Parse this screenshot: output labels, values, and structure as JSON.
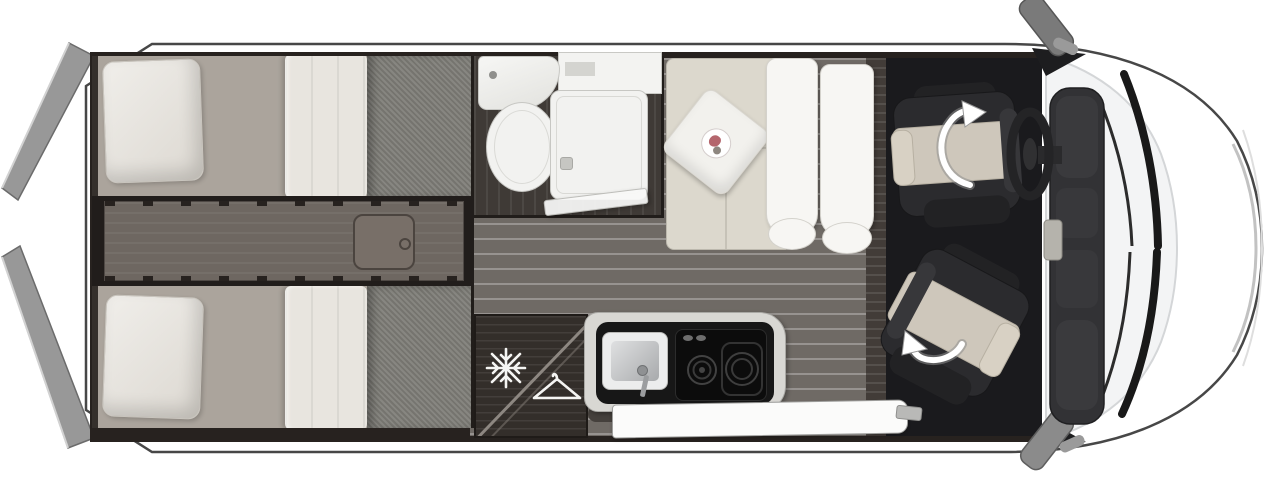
{
  "scene": {
    "subject": "camper-van-floor-plan-top-view",
    "background_color": "#ffffff",
    "orientation": "van front on the right, rear doors open on the left"
  },
  "palette": {
    "body_white": "#ffffff",
    "body_outline": "#474747",
    "door_grey": "#989898",
    "wall_dark": "#27221f",
    "plank_floor": "#6f6a65",
    "bathroom_floor": "#3f3a36",
    "dark_wood_cabinet": "#332e2a",
    "bed_sheet": "#aba49c",
    "bed_duvet": "#81807a",
    "linen_white": "#e9e7e2",
    "sofa_beige": "#dcd8cd",
    "seat_back_white": "#f7f6f3",
    "counter_rim": "#d8d7d3",
    "counter_top": "#171717",
    "cab_mat": "#1a1a1d",
    "seat_dark": "#2b2b2e",
    "seat_beige": "#cec7bb",
    "fixture_white": "#f2f2f0",
    "icon_white": "#f5f5f3",
    "arrow_white": "#ffffff",
    "arrow_shadow": "#8e8e8e",
    "hatch_grey": "#786f68",
    "console_grey": "#6e6761",
    "wiper_black": "#191919",
    "dashboard_grey": "#323235",
    "mirror_grey": "#7a7a7a"
  },
  "icons": {
    "fridge": {
      "name": "snowflake-icon",
      "glyph": "❄",
      "meaning": "refrigerator compartment"
    },
    "wardrobe": {
      "name": "hanger-icon",
      "glyph": "⧍",
      "meaning": "clothes wardrobe"
    },
    "driver_swivel": {
      "name": "swivel-arrow-icon",
      "meaning": "driver seat rotates"
    },
    "passenger_swivel": {
      "name": "swivel-arrow-icon",
      "meaning": "passenger seat rotates"
    }
  },
  "zones": {
    "rear_bedroom": "twin-single-beds",
    "bathroom": "basin-toilet-shower",
    "lounge": "sofa-with-two-travel-seat-backrests",
    "kitchen": "sink-and-two-burner-hob",
    "storage": "fridge-and-wardrobe-cabinet",
    "cab": "swivel-driver-and-passenger-seats",
    "entry": "sliding-door-step"
  }
}
